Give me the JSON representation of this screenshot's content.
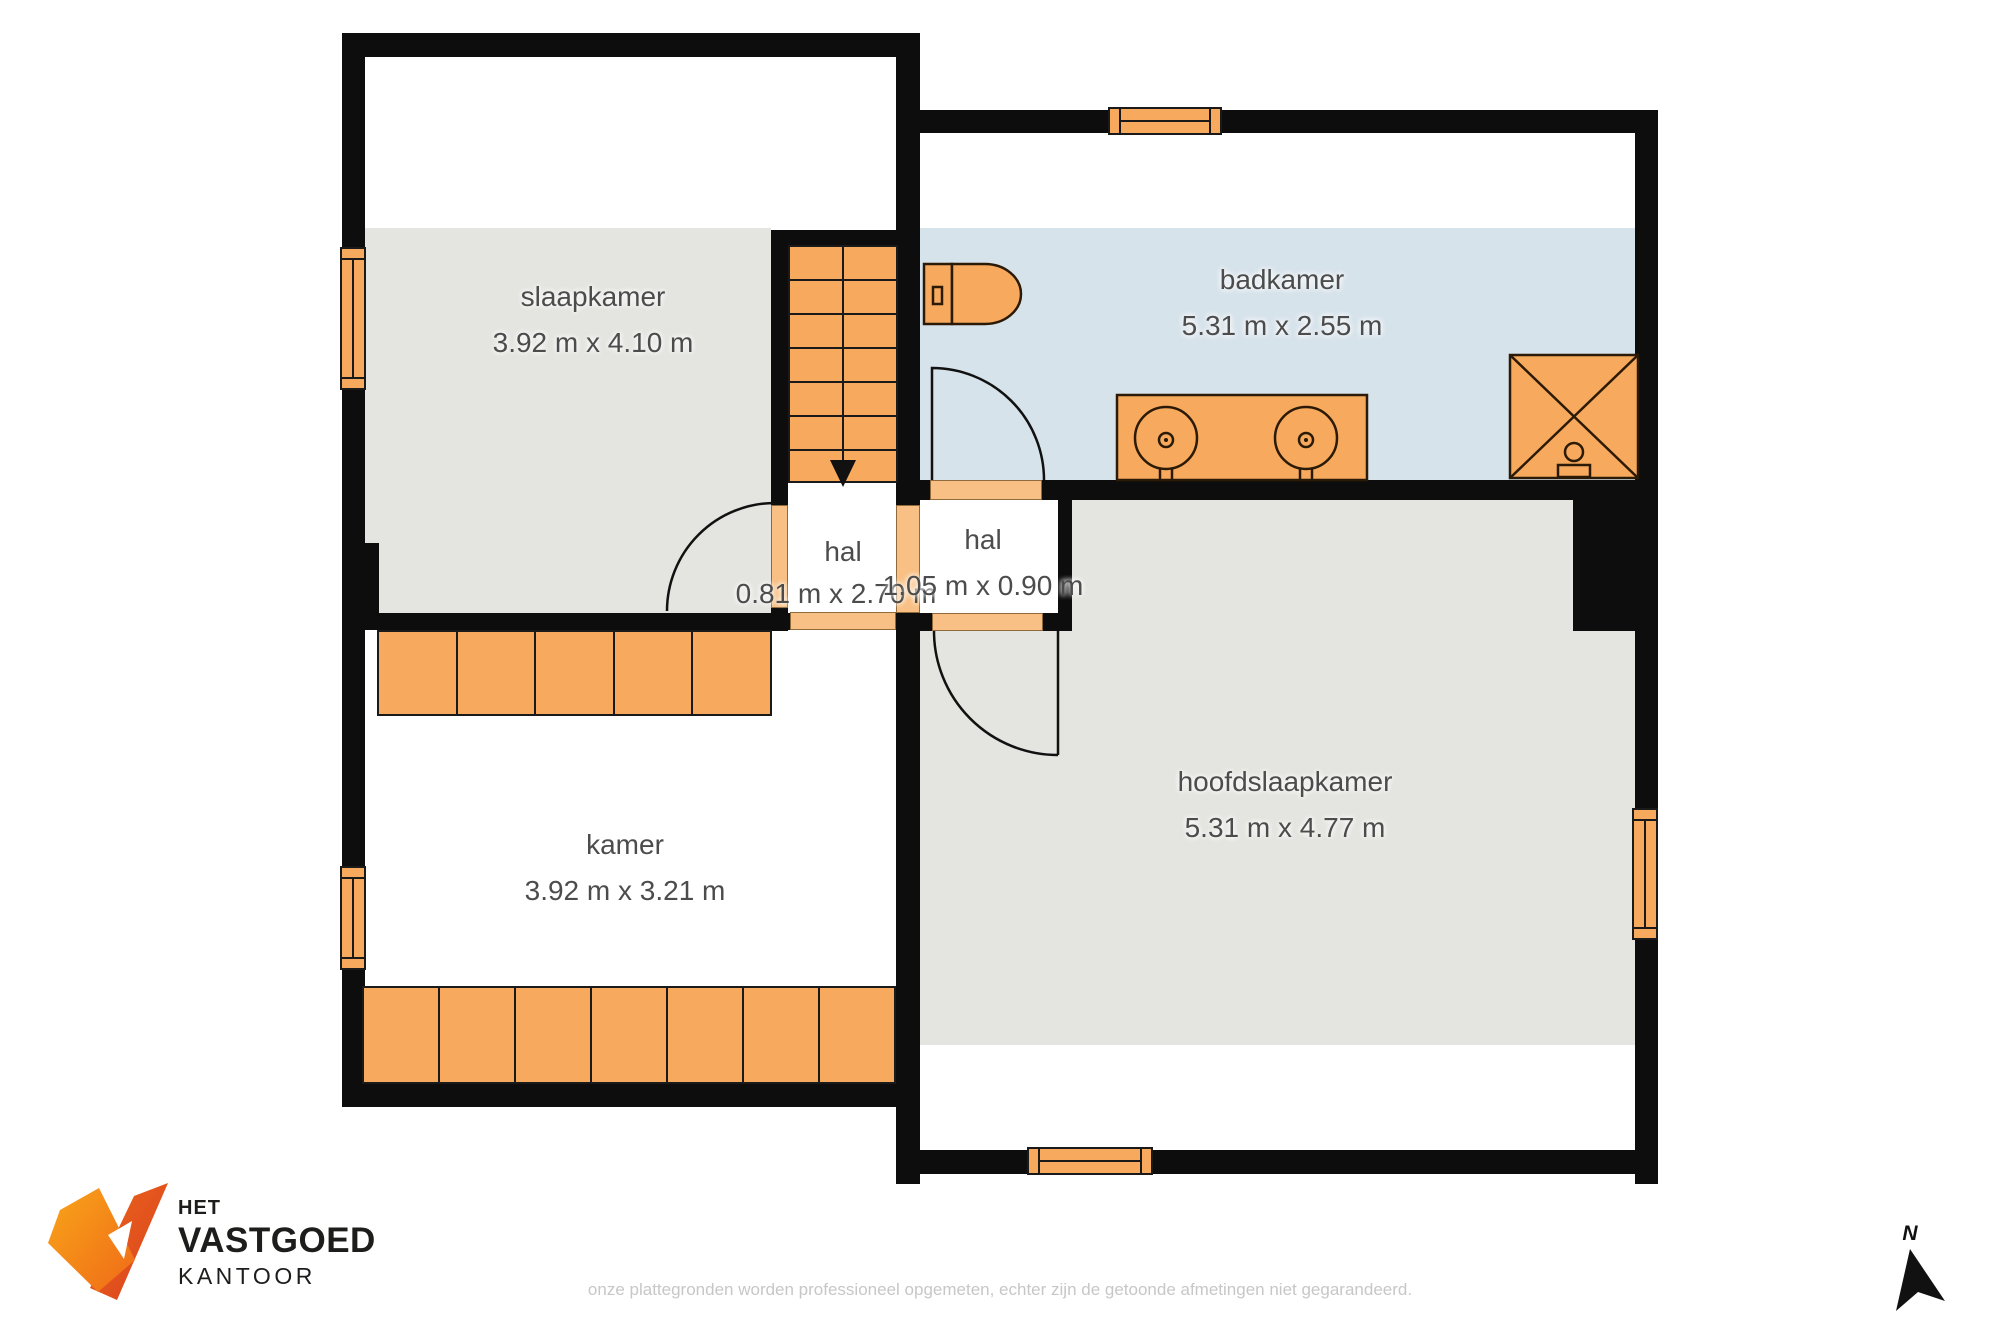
{
  "plan_title": "floorplan-verdieping",
  "rooms": [
    {
      "id": "slaapkamer",
      "name": "slaapkamer",
      "dimensions": "3.92 m x 4.10 m"
    },
    {
      "id": "badkamer",
      "name": "badkamer",
      "dimensions": "5.31 m x 2.55 m"
    },
    {
      "id": "hal-links",
      "name": "hal",
      "dimensions": "0.81 m x 2.70 m"
    },
    {
      "id": "hal-rechts",
      "name": "hal",
      "dimensions": "1.05 m x 0.90 m"
    },
    {
      "id": "kamer",
      "name": "kamer",
      "dimensions": "3.92 m x 3.21 m"
    },
    {
      "id": "hoofdslaapkamer",
      "name": "hoofdslaapkamer",
      "dimensions": "5.31 m x 4.77 m"
    }
  ],
  "logo": {
    "line1": "HET",
    "line2": "VASTGOED",
    "line3": "KANTOOR"
  },
  "footer": {
    "disclaimer": "onze plattegronden worden professioneel opgemeten, echter zijn de getoonde afmetingen niet gegarandeerd."
  },
  "compass": {
    "north_label": "N"
  },
  "icons": [
    "toilet-icon",
    "double-sink-icon",
    "shower-icon",
    "stairs-down-arrow-icon",
    "north-arrow-icon",
    "window-icon",
    "door-arc-icon",
    "logo-v-mark-icon"
  ],
  "colors": {
    "wall": "#0d0d0d",
    "furniture_orange": "#F7A95E",
    "threshold_orange": "#F8C084",
    "floor_gray": "#E4E4E0",
    "floor_blue_bathroom": "#D7E3EB",
    "label_text": "#4c4c4c",
    "disclaimer_text": "#c7c7c7",
    "logo_orange_light": "#F9A51A",
    "logo_orange_dark": "#D8401E",
    "logo_text": "#1d1d1b"
  }
}
